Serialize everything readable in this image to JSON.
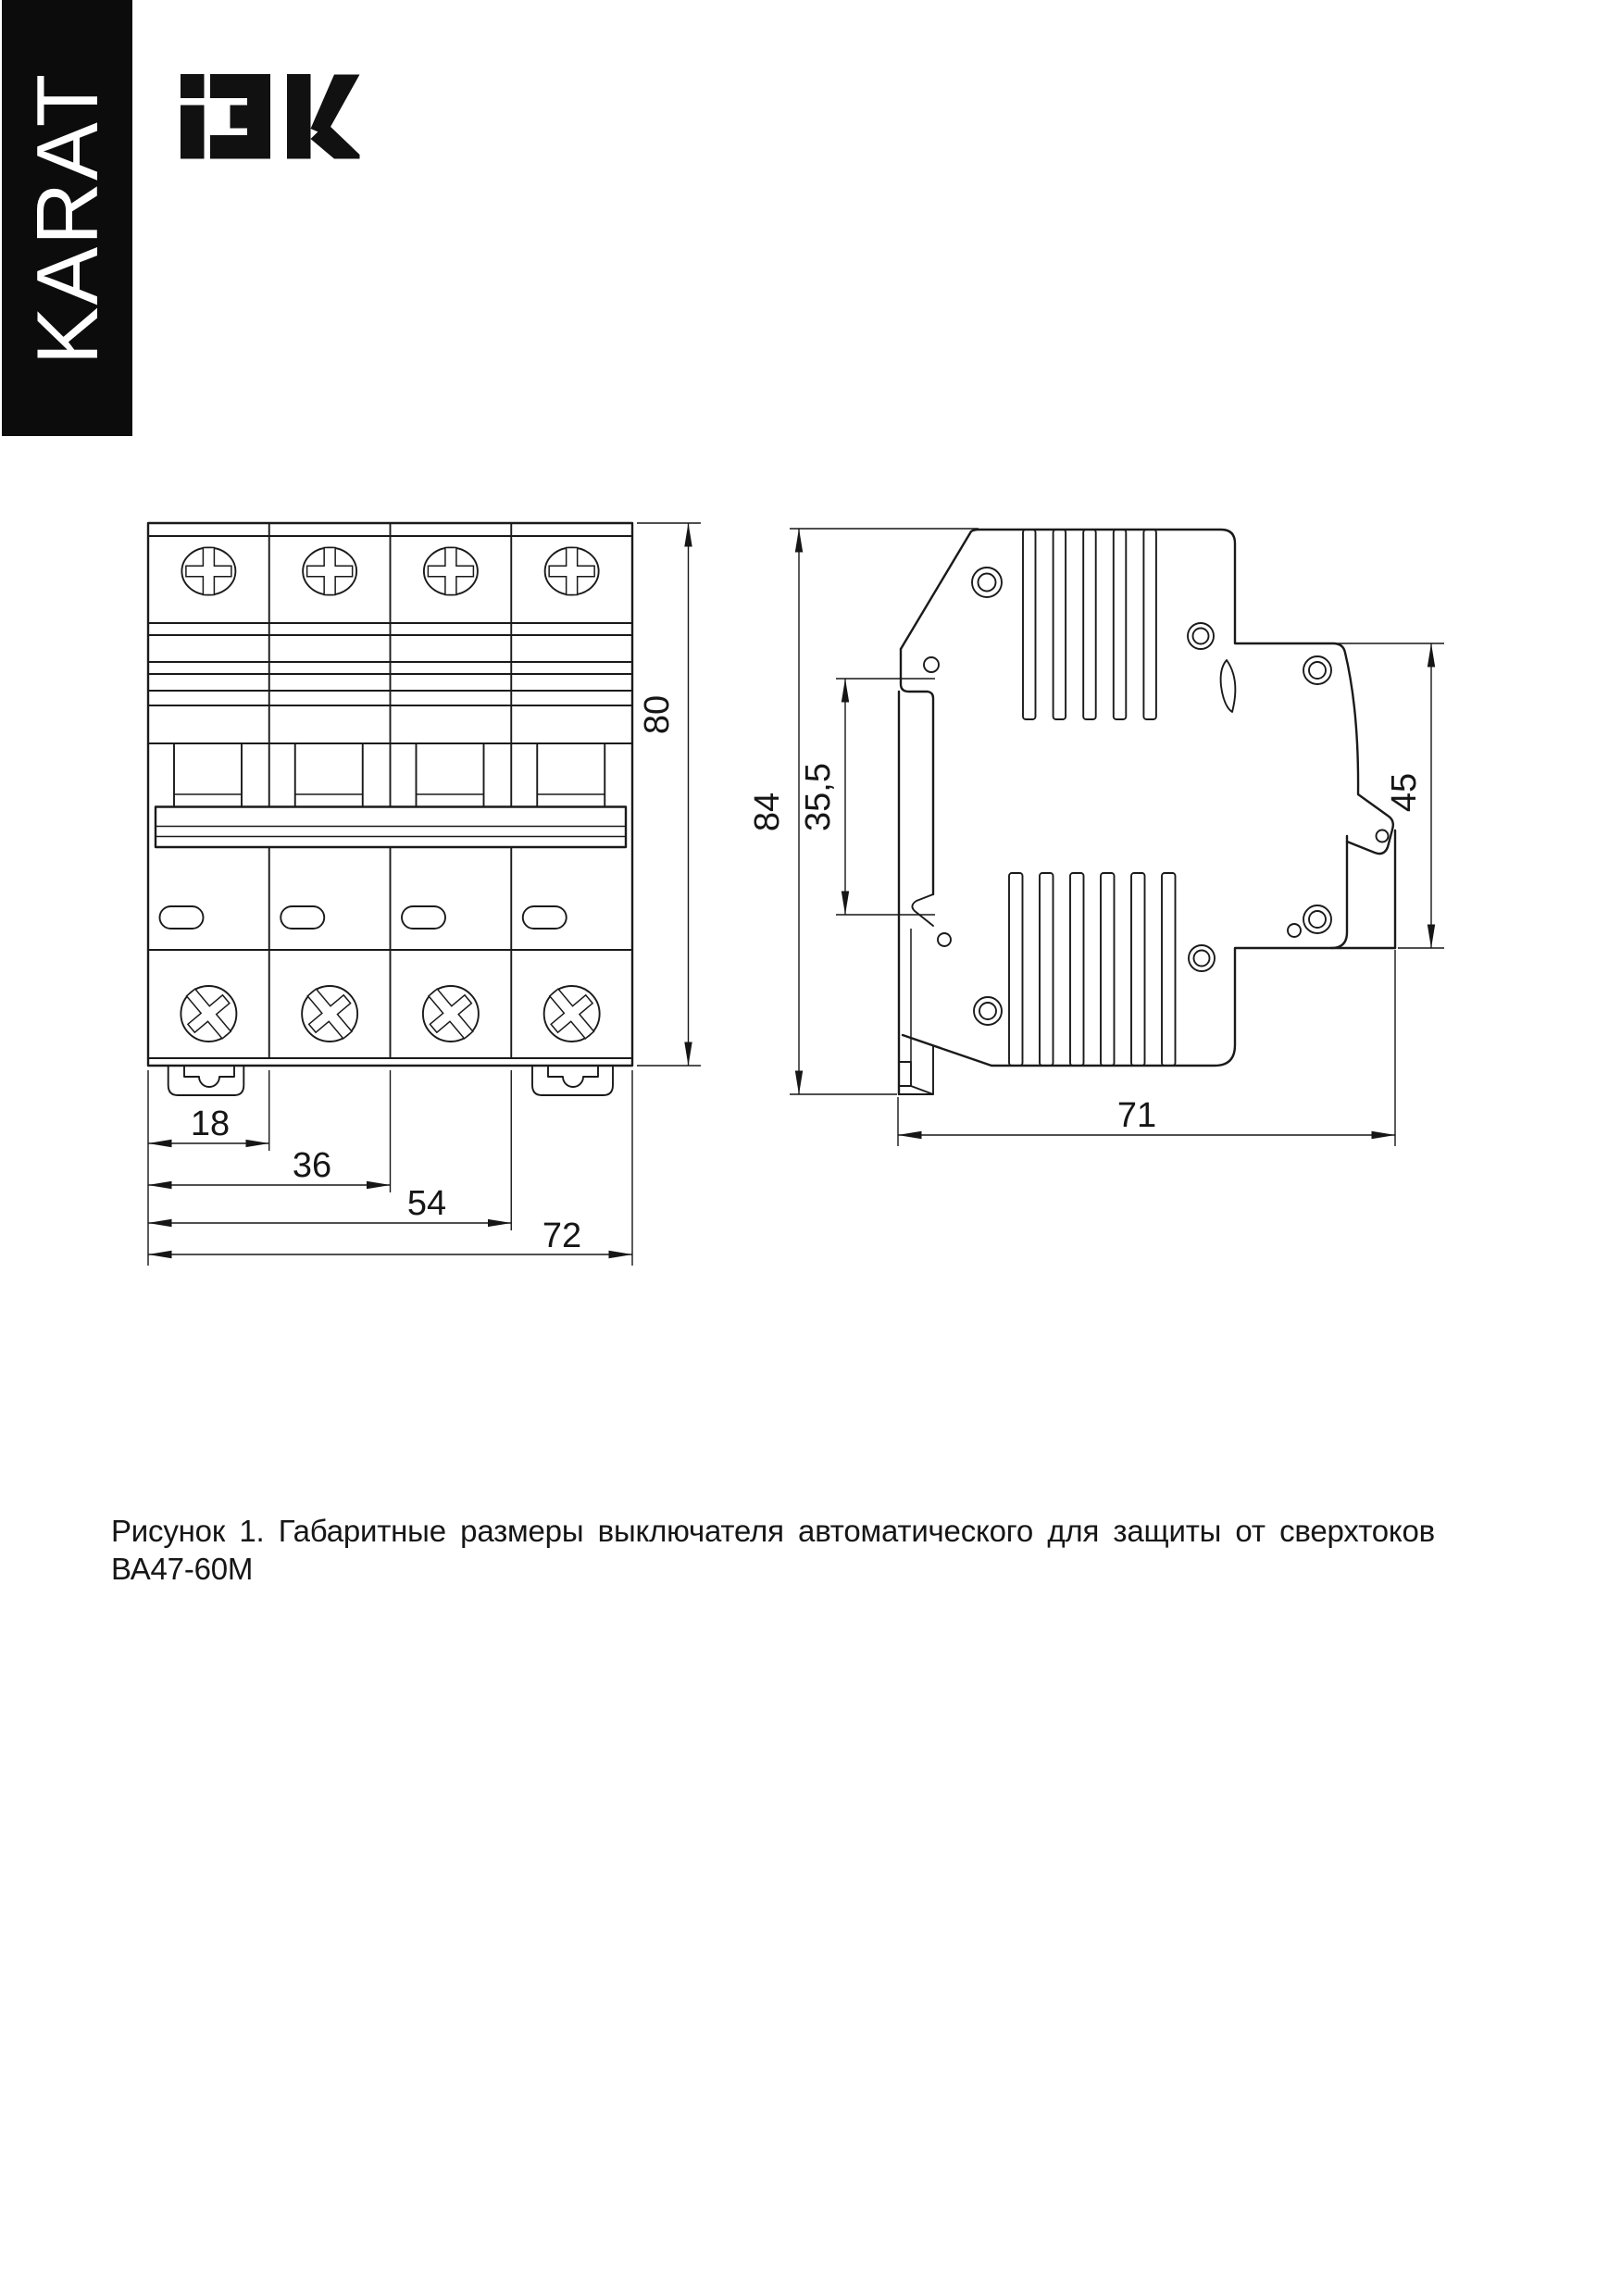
{
  "sidebar": {
    "brand": "KARAT"
  },
  "header": {
    "logo": "IEK"
  },
  "figure": {
    "front_view": {
      "height_mm": "80",
      "widths_mm": [
        "18",
        "36",
        "54",
        "72"
      ]
    },
    "side_view": {
      "height_mm": "84",
      "din_channel_mm": "35,5",
      "front_height_mm": "45",
      "depth_mm": "71"
    }
  },
  "caption": "Рисунок 1. Габаритные размеры выключателя автоматического для защиты от сверхтоков ВА47-60М"
}
